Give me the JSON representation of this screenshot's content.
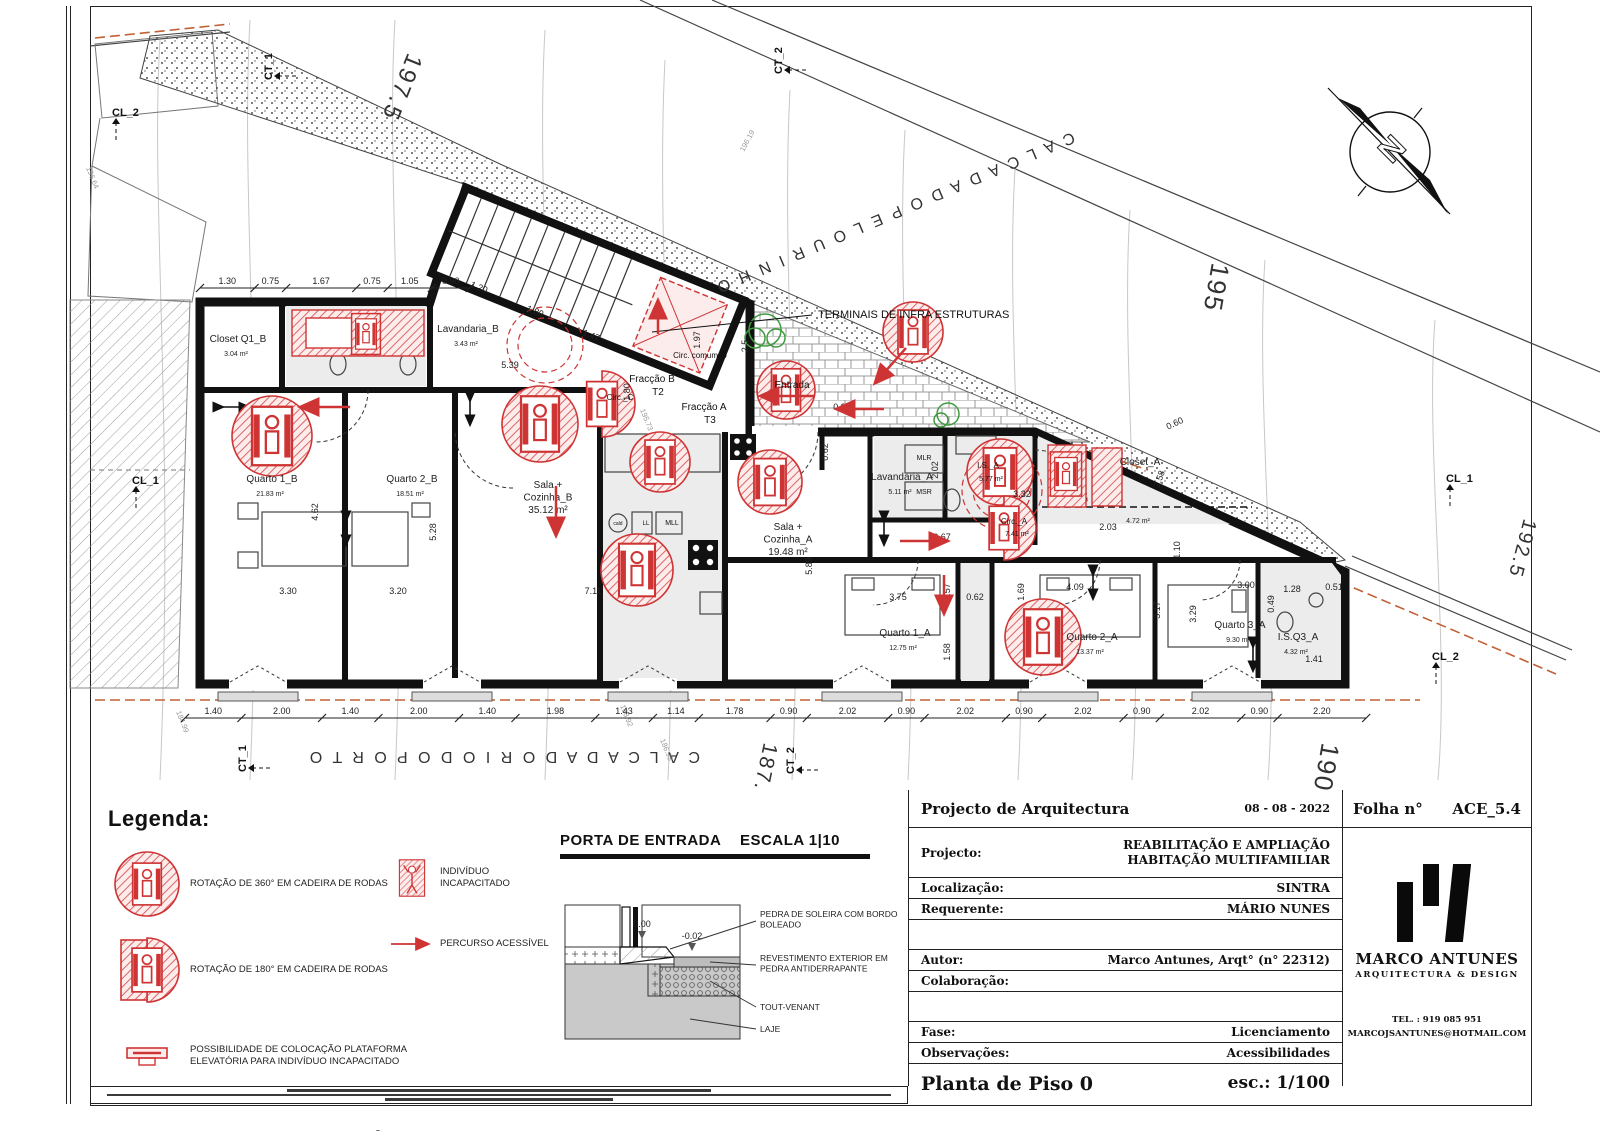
{
  "colors": {
    "accent_red": "#cf3434",
    "wall": "#111111",
    "floor_gray": "#ececec",
    "contour": "#c7c7c7",
    "orange_dash": "#c06034",
    "green": "#3f9b3f"
  },
  "plan": {
    "streets": [
      {
        "label": "C A L C A D A   D O   P E L O U R I N H O",
        "x": 1072,
        "y": 132,
        "rot": 157,
        "size": 16
      },
      {
        "label": "C A L C A D A   D O   R I O   D O   P O R T O",
        "x": 700,
        "y": 752,
        "rot": 180,
        "size": 16
      }
    ],
    "elevations": [
      {
        "t": "197.5",
        "x": 408,
        "y": 52,
        "r": 112,
        "s": 24
      },
      {
        "t": "195",
        "x": 1212,
        "y": 262,
        "r": 100,
        "s": 26
      },
      {
        "t": "192.5",
        "x": 1524,
        "y": 518,
        "r": 105,
        "s": 20
      },
      {
        "t": "190",
        "x": 1322,
        "y": 742,
        "r": 100,
        "s": 26
      },
      {
        "t": "187.5",
        "x": 764,
        "y": 742,
        "r": 102,
        "s": 21
      }
    ],
    "contour_labels": [
      {
        "t": "195.73",
        "x": 640,
        "y": 410,
        "r": 68
      },
      {
        "t": "196.19",
        "x": 744,
        "y": 152,
        "r": -62
      },
      {
        "t": "196.64",
        "x": 86,
        "y": 168,
        "r": 68
      },
      {
        "t": "188.92",
        "x": 620,
        "y": 706,
        "r": 68
      },
      {
        "t": "186.93",
        "x": 660,
        "y": 740,
        "r": 68
      },
      {
        "t": "184.99",
        "x": 176,
        "y": 712,
        "r": 68
      }
    ],
    "markers": [
      {
        "t": "CL_2",
        "x": 112,
        "y": 116,
        "r": 0
      },
      {
        "t": "CT_1",
        "x": 272,
        "y": 80,
        "r": -90
      },
      {
        "t": "CT_2",
        "x": 782,
        "y": 74,
        "r": -90
      },
      {
        "t": "CL_1",
        "x": 132,
        "y": 484,
        "r": 0
      },
      {
        "t": "CL_1",
        "x": 1446,
        "y": 482,
        "r": 0
      },
      {
        "t": "CL_2",
        "x": 1432,
        "y": 660,
        "r": 0
      },
      {
        "t": "CT_1",
        "x": 246,
        "y": 772,
        "r": -90
      },
      {
        "t": "CT_2",
        "x": 794,
        "y": 774,
        "r": -90
      }
    ],
    "rooms": [
      {
        "name": "Closet Q1_B",
        "area": "3.04 m²",
        "x": 238,
        "y": 342
      },
      {
        "name": "Lavandaria_B",
        "area": "3.43 m²",
        "x": 468,
        "y": 332
      },
      {
        "name": "Quarto 1_B",
        "area": "21.83 m²",
        "x": 272,
        "y": 482
      },
      {
        "name": "Quarto 2_B",
        "area": "18.51 m²",
        "x": 412,
        "y": 482
      },
      {
        "name": "Sala +\nCozinha_B\n35.12 m²",
        "area": "",
        "x": 548,
        "y": 488
      },
      {
        "name": "Sala +\nCozinha_A\n19.48 m²",
        "area": "",
        "x": 788,
        "y": 530
      },
      {
        "name": "Lavandaria_A",
        "area": "5.11 m²",
        "x": 902,
        "y": 480
      },
      {
        "name": "Closet_A",
        "x": 1140,
        "y": 465,
        "area": "4.72 m²",
        "areay": 523
      },
      {
        "name": "Quarto 1_A",
        "area": "12.75 m²",
        "x": 905,
        "y": 636
      },
      {
        "name": "Quarto 2_A",
        "area": "13.37 m²",
        "x": 1092,
        "y": 640
      },
      {
        "name": "Quarto 3_A",
        "area": "9.30 m²",
        "x": 1240,
        "y": 628
      },
      {
        "name": "I.S.Q3_A",
        "area": "4.32 m²",
        "x": 1298,
        "y": 640
      }
    ],
    "annotations": [
      {
        "t": "TERMINAIS DE INFRA ESTRUTURAS",
        "x": 818,
        "y": 318,
        "s": 11,
        "a": "start"
      },
      {
        "t": "Entrada",
        "x": 792,
        "y": 388,
        "s": 10
      },
      {
        "t": "Fracção B",
        "x": 652,
        "y": 382,
        "s": 10
      },
      {
        "t": "T2",
        "x": 658,
        "y": 395,
        "s": 10
      },
      {
        "t": "Fracção A",
        "x": 704,
        "y": 410,
        "s": 10
      },
      {
        "t": "T3",
        "x": 710,
        "y": 423,
        "s": 10
      },
      {
        "t": "Circ. comum_0",
        "x": 700,
        "y": 358,
        "s": 8
      },
      {
        "t": "Circ._C",
        "x": 620,
        "y": 400,
        "s": 8
      },
      {
        "t": "I.S._A",
        "x": 988,
        "y": 468,
        "s": 8
      },
      {
        "t": "5.77 m²",
        "x": 991,
        "y": 481,
        "s": 7
      },
      {
        "t": "Circ._A",
        "x": 1014,
        "y": 524,
        "s": 8
      },
      {
        "t": "7.41 m²",
        "x": 1017,
        "y": 536,
        "s": 7
      },
      {
        "t": "MLR",
        "x": 924,
        "y": 460,
        "s": 7
      },
      {
        "t": "MSR",
        "x": 924,
        "y": 494,
        "s": 7
      },
      {
        "t": "MLL",
        "x": 672,
        "y": 525,
        "s": 7
      },
      {
        "t": "LL",
        "x": 646,
        "y": 525,
        "s": 6
      },
      {
        "t": "cald",
        "x": 618,
        "y": 525,
        "s": 5
      }
    ],
    "dims_top": {
      "y": 288,
      "x0": 200,
      "scale": 42,
      "values": [
        "1.30",
        "0.75",
        "1.67",
        "0.75",
        "1.05",
        "0.90"
      ]
    },
    "dims_bottom": {
      "y": 718,
      "x0": 185,
      "scale": 40.3,
      "values": [
        "1.40",
        "2.00",
        "1.40",
        "2.00",
        "1.40",
        "1.98",
        "1.43",
        "1.14",
        "1.78",
        "0.90",
        "2.02",
        "0.90",
        "2.02",
        "0.90",
        "2.02",
        "0.90",
        "2.02",
        "0.90",
        "2.20"
      ]
    },
    "dims_inline": [
      {
        "t": "5.39",
        "x": 510,
        "y": 368,
        "r": 0
      },
      {
        "t": "1.97",
        "x": 700,
        "y": 340,
        "r": -90
      },
      {
        "t": "3.30",
        "x": 288,
        "y": 594,
        "r": 0
      },
      {
        "t": "3.20",
        "x": 398,
        "y": 594,
        "r": 0
      },
      {
        "t": "7.11",
        "x": 593,
        "y": 594,
        "r": 0
      },
      {
        "t": "5.28",
        "x": 436,
        "y": 532,
        "r": -90
      },
      {
        "t": "4.62",
        "x": 318,
        "y": 512,
        "r": -90
      },
      {
        "t": "5.89",
        "x": 812,
        "y": 566,
        "r": -90
      },
      {
        "t": "3.75",
        "x": 898,
        "y": 600,
        "r": 0
      },
      {
        "t": "6.67",
        "x": 942,
        "y": 540,
        "r": 0
      },
      {
        "t": "0.62",
        "x": 975,
        "y": 600,
        "r": 0
      },
      {
        "t": "0.62",
        "x": 828,
        "y": 452,
        "r": -90
      },
      {
        "t": "1.57",
        "x": 950,
        "y": 592,
        "r": -90
      },
      {
        "t": "1.58",
        "x": 950,
        "y": 652,
        "r": -90
      },
      {
        "t": "1.69",
        "x": 1024,
        "y": 592,
        "r": -90
      },
      {
        "t": "4.09",
        "x": 1075,
        "y": 590,
        "r": 0
      },
      {
        "t": "3.17",
        "x": 1160,
        "y": 610,
        "r": -90
      },
      {
        "t": "3.29",
        "x": 1196,
        "y": 614,
        "r": -90
      },
      {
        "t": "3.00",
        "x": 1246,
        "y": 588,
        "r": 0
      },
      {
        "t": "2.03",
        "x": 1108,
        "y": 530,
        "r": 0
      },
      {
        "t": "1.10",
        "x": 1180,
        "y": 550,
        "r": -90
      },
      {
        "t": "1.28",
        "x": 1292,
        "y": 592,
        "r": 0
      },
      {
        "t": "0.51",
        "x": 1334,
        "y": 590,
        "r": 0
      },
      {
        "t": "0.49",
        "x": 1274,
        "y": 604,
        "r": -90
      },
      {
        "t": "1.41",
        "x": 1314,
        "y": 662,
        "r": 0
      },
      {
        "t": "2.58",
        "x": 1162,
        "y": 480,
        "r": -70
      },
      {
        "t": "0.60",
        "x": 1176,
        "y": 426,
        "r": -25
      },
      {
        "t": "3.32",
        "x": 1022,
        "y": 497,
        "r": 0
      },
      {
        "t": "2.02",
        "x": 938,
        "y": 470,
        "r": -90
      },
      {
        "t": "1.80",
        "x": 630,
        "y": 392,
        "r": -90
      },
      {
        "t": "2.5",
        "x": 748,
        "y": 346,
        "r": -90
      },
      {
        "t": "1.20",
        "x": 478,
        "y": 290,
        "r": 22
      },
      {
        "t": "1.89",
        "x": 534,
        "y": 314,
        "r": 22
      },
      {
        "t": "1.47",
        "x": 590,
        "y": 338,
        "r": 22
      },
      {
        "t": "0.90",
        "x": 842,
        "y": 410,
        "r": 0
      }
    ],
    "symbols": [
      {
        "type": "c360",
        "x": 272,
        "y": 436,
        "r": 40
      },
      {
        "type": "c360",
        "x": 540,
        "y": 424,
        "r": 38
      },
      {
        "type": "c360",
        "x": 660,
        "y": 462,
        "r": 30
      },
      {
        "type": "c360",
        "x": 770,
        "y": 482,
        "r": 32
      },
      {
        "type": "c360",
        "x": 913,
        "y": 332,
        "r": 30
      },
      {
        "type": "c360",
        "x": 1000,
        "y": 472,
        "r": 33
      },
      {
        "type": "c360",
        "x": 637,
        "y": 570,
        "r": 36
      },
      {
        "type": "c360",
        "x": 1043,
        "y": 637,
        "r": 38
      },
      {
        "type": "c360",
        "x": 786,
        "y": 390,
        "r": 29
      },
      {
        "type": "c180",
        "x": 602,
        "y": 404,
        "r": 33
      },
      {
        "type": "c180",
        "x": 1004,
        "y": 528,
        "r": 32
      },
      {
        "type": "box",
        "x": 366,
        "y": 334,
        "r": 24
      },
      {
        "type": "box",
        "x": 1066,
        "y": 474,
        "r": 26
      }
    ],
    "arrows": [
      [
        350,
        407,
        302,
        407
      ],
      [
        815,
        396,
        762,
        396
      ],
      [
        884,
        409,
        838,
        409
      ],
      [
        556,
        486,
        556,
        534
      ],
      [
        658,
        334,
        658,
        302
      ],
      [
        900,
        541,
        946,
        541
      ],
      [
        944,
        575,
        944,
        612
      ],
      [
        906,
        348,
        876,
        382
      ]
    ],
    "north_label": "N"
  },
  "legend": {
    "title": "Legenda:",
    "items_left": [
      {
        "icon": "circle360",
        "label": "ROTAÇÃO DE 360° EM CADEIRA DE RODAS"
      },
      {
        "icon": "circle180",
        "label": "ROTAÇÃO DE 180° EM CADEIRA DE RODAS"
      },
      {
        "icon": "platform",
        "label": "POSSIBILIDADE DE COLOCAÇÃO PLATAFORMA\nELEVATÓRIA PARA INDIVÍDUO INCAPACITADO"
      },
      {
        "icon": "dashes",
        "label": "PAREDE COM CAPACIDADE PARA FIXAÇÃO\nDE BARRAS DE APOIO"
      }
    ],
    "items_right": [
      {
        "icon": "person",
        "label": "INDIVÍDUO INCAPACITADO"
      },
      {
        "icon": "arrow",
        "label": "PERCURSO ACESSÍVEL"
      }
    ]
  },
  "detail": {
    "title": "PORTA DE ENTRADA",
    "scale": "ESCALA 1|10",
    "levels": [
      "0.00",
      "-0.02"
    ],
    "labels": [
      "PEDRA DE SOLEIRA COM BORDO\nBOLEADO",
      "REVESTIMENTO EXTERIOR EM\nPEDRA ANTIDERRAPANTE",
      "TOUT-VENANT",
      "LAJE"
    ]
  },
  "titleblock": {
    "header": "Projecto de Arquitectura",
    "date": "08 - 08 - 2022",
    "folha_label": "Folha n°",
    "folha_value": "ACE_5.4",
    "rows": [
      {
        "label": "Projecto:",
        "value": "REABILITAÇÃO E AMPLIAÇÃO\nHABITAÇÃO MULTIFAMILIAR"
      },
      {
        "label": "Localização:",
        "value": "SINTRA"
      },
      {
        "label": "Requerente:",
        "value": "MÁRIO NUNES"
      },
      {
        "label": "Autor:",
        "value": "Marco Antunes, Arqt° (n° 22312)"
      },
      {
        "label": "Colaboração:",
        "value": ""
      },
      {
        "label": "Fase:",
        "value": "Licenciamento"
      },
      {
        "label": "Observações:",
        "value": "Acessibilidades"
      }
    ],
    "footer_label": "Planta de Piso 0",
    "footer_scale": "esc.: 1/100",
    "firm": {
      "name": "MARCO ANTUNES",
      "tag": "ARQUITECTURA & DESIGN",
      "tel": "TEL. : 919 085 951",
      "email": "MARCOJSANTUNES@HOTMAIL.COM"
    }
  }
}
